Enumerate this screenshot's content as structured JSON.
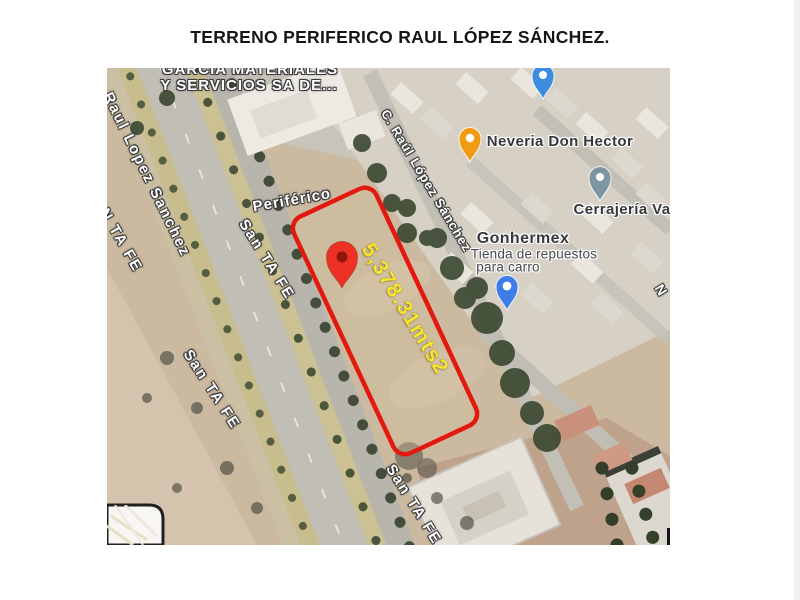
{
  "title": "TERRENO PERIFERICO RAUL LÓPEZ SÁNCHEZ.",
  "map": {
    "parcel": {
      "area_label": "5,378.31mts2",
      "outline_color": "#e2190e",
      "area_label_color": "#f5e62e"
    },
    "streets": {
      "raul_lopez_sanchez": "Raul Lopez Sanchez",
      "san_ta_fe_far_left": "SAN TA FE",
      "san_ta_fe_upper": "San TA FE",
      "san_ta_fe_mid": "San TA FE",
      "san_ta_fe_bottom": "San TA FE",
      "c_raul_lopez_sanchez": "C. Raúl López Sánchez",
      "periferico": "Periférico",
      "n_partial": "N"
    },
    "pois": {
      "garcia": {
        "line1": "GARCIA MATERIALES",
        "line2": "Y SERVICIOS SA DE..."
      },
      "neveria": {
        "name": "Neveria Don Hector"
      },
      "cerrajeria": {
        "name": "Cerrajería Va"
      },
      "gonhermex": {
        "name": "Gonhermex",
        "sub1": "Tienda de repuestos",
        "sub2": "para carro"
      }
    },
    "pin_colors": {
      "parcel_marker": "#ed3124",
      "neveria": "#f09b13",
      "cerrajeria": "#7e95a2",
      "gonhermex": "#3d7de8",
      "top_partial": "#3c8ce0"
    }
  }
}
